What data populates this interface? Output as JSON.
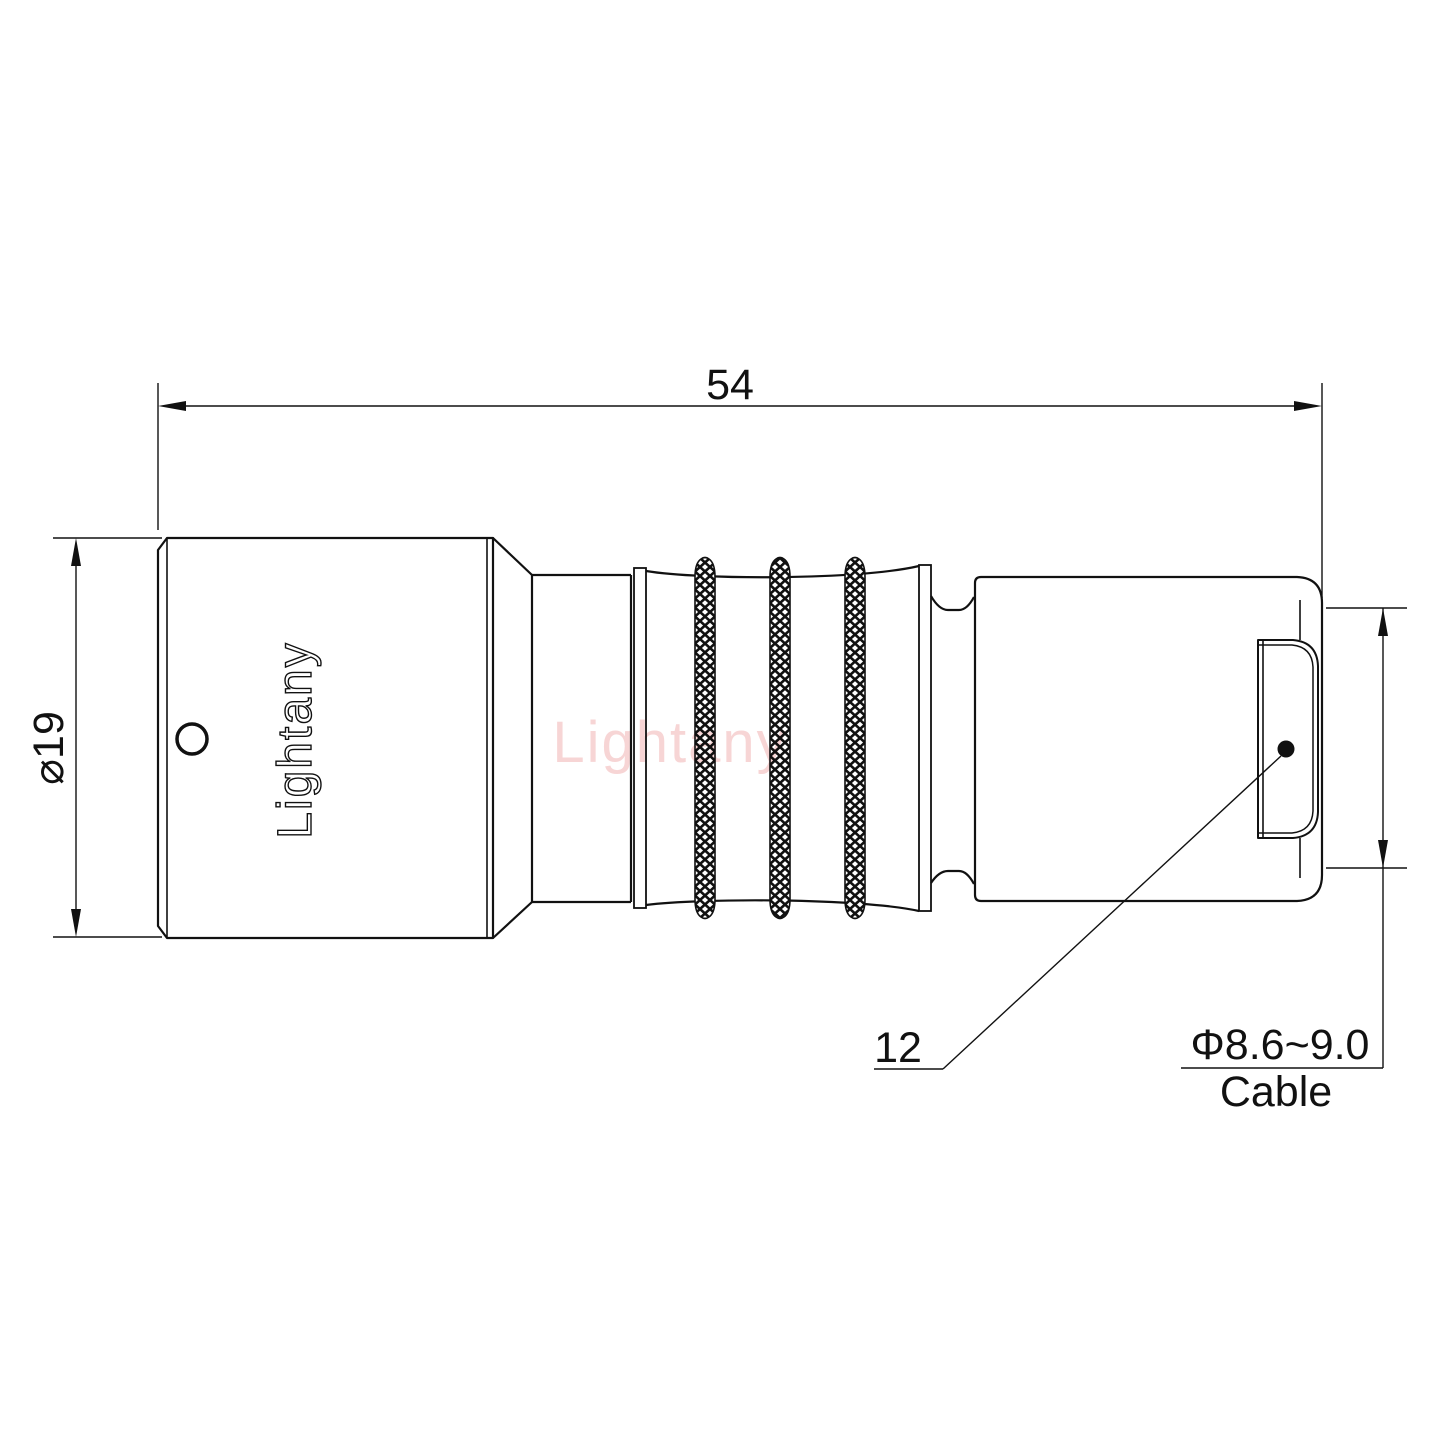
{
  "brand": {
    "embossed_text": "Lightany",
    "watermark_text": "Lightany"
  },
  "dimensions": {
    "overall_length": "54",
    "outer_diameter": "⌀19",
    "bushing_ref": "12",
    "cable_range": "Φ8.6~9.0",
    "cable_word": "Cable"
  },
  "colors": {
    "line": "#111111",
    "watermark": "#f7d5d5",
    "background": "#ffffff"
  }
}
